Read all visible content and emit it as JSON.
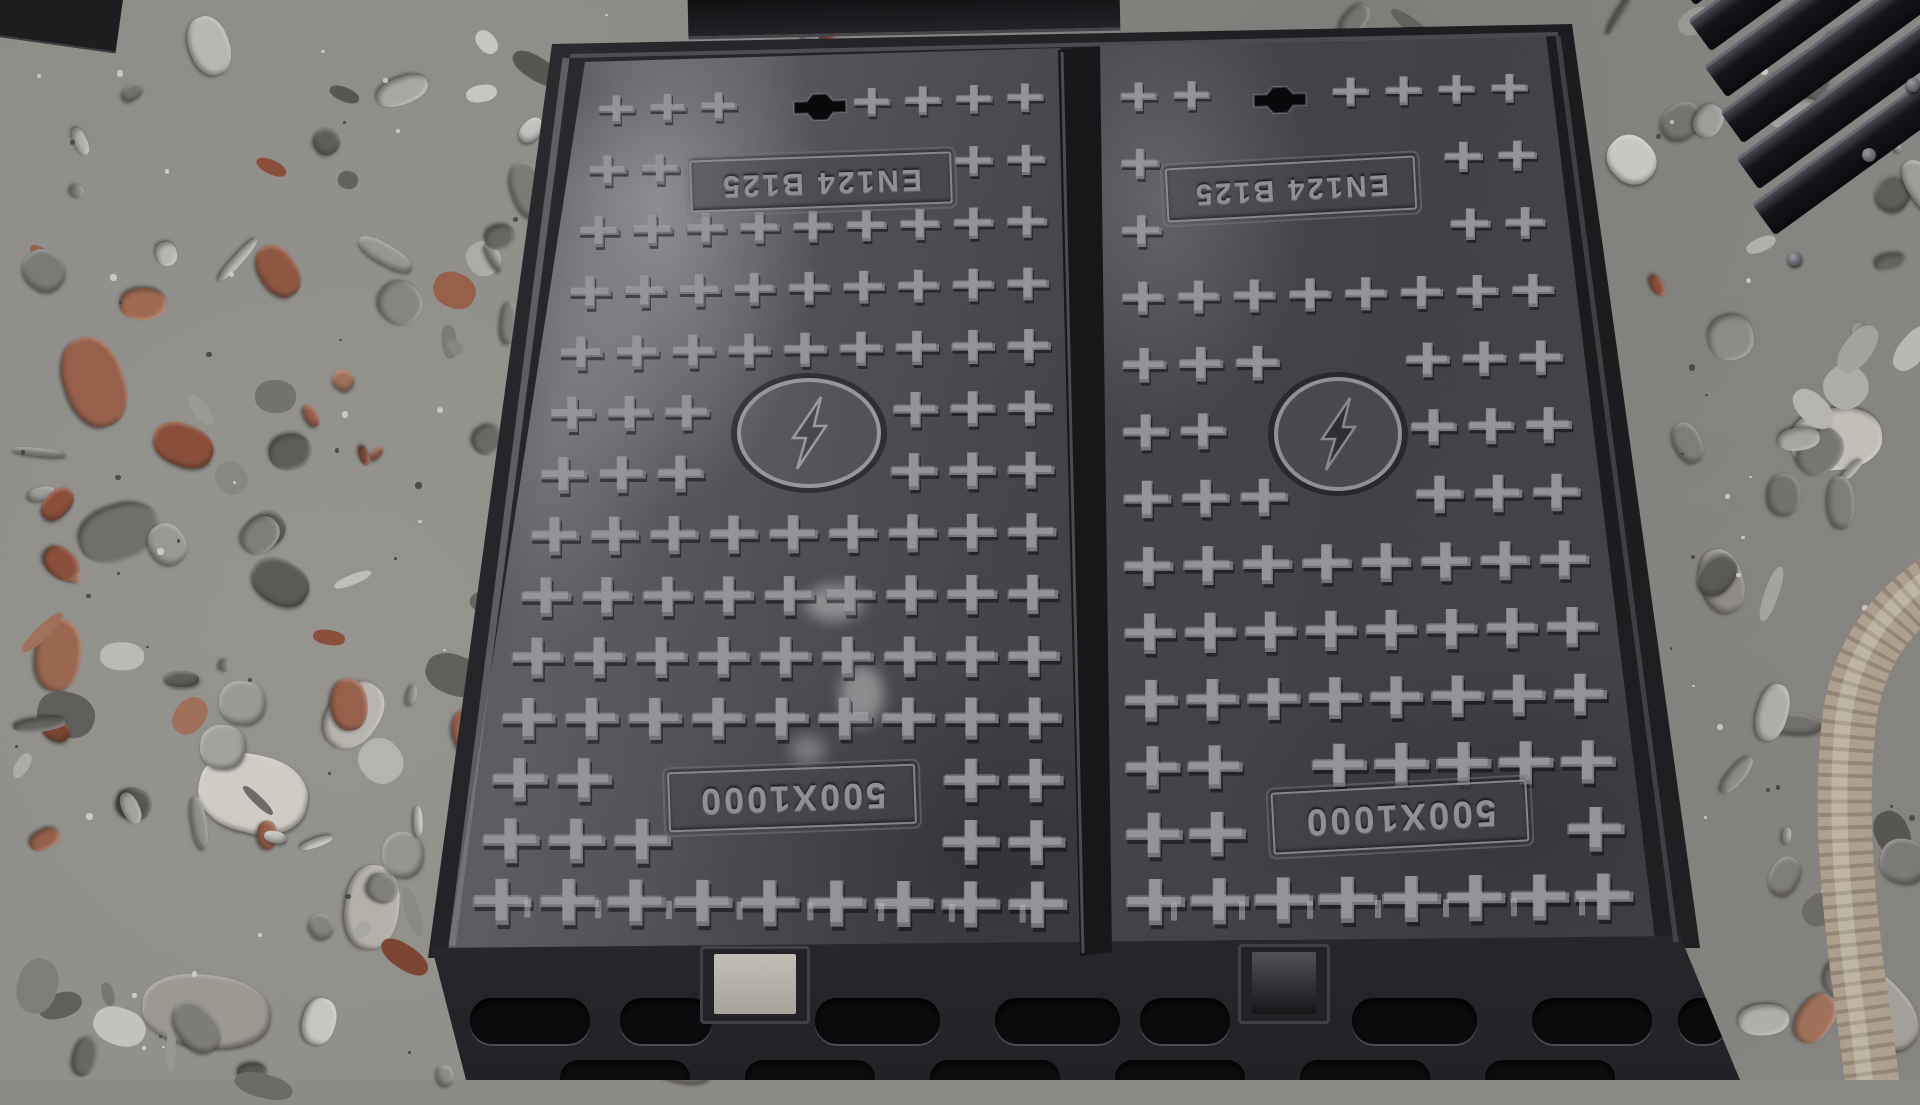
{
  "scene": {
    "type": "photograph",
    "subject": "Two cast-iron electric utility trench covers set in a common frame, lying on gravel ground",
    "ground": "grey gravel and crushed stone with red brick fragments",
    "background_objects": [
      "stack of dark iron castings (top right)",
      "beige corrugated hose (right edge)",
      "dark casting edge (top center)"
    ]
  },
  "covers": [
    {
      "position": "left",
      "standard_label": "EN124 B125",
      "size_label": "500X1000",
      "emblem": "electricity-lightning-in-circle",
      "surface_pattern": "raised cross (plus) studs",
      "text_orientation": "rotated 180 degrees"
    },
    {
      "position": "right",
      "standard_label": "EN124 B125",
      "size_label": "500X1000",
      "emblem": "electricity-lightning-in-circle",
      "surface_pattern": "raised cross (plus) studs",
      "text_orientation": "rotated 180 degrees"
    }
  ],
  "colors": {
    "cover_metal": "#45454b",
    "metal_highlight": "#8a8a92",
    "frame_dark": "#1c1c1f",
    "gravel": "#8d8b87",
    "brick_red": "#96604b",
    "hose": "#b3a593"
  }
}
